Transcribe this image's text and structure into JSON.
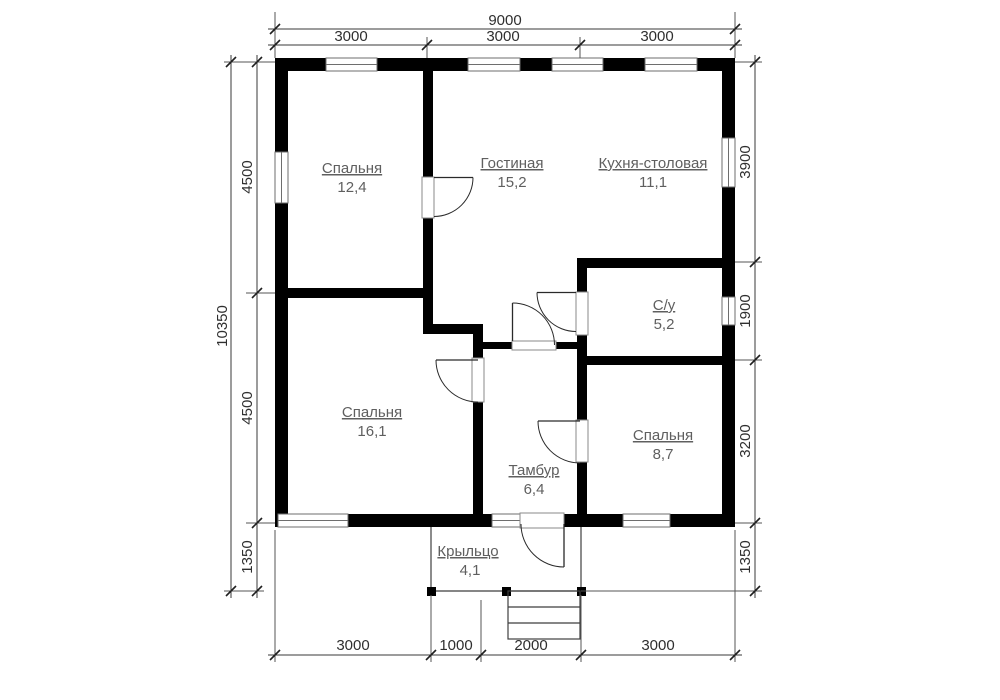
{
  "plan": {
    "rooms": [
      {
        "name": "Спальня",
        "area": "12,4"
      },
      {
        "name": "Гостиная",
        "area": "15,2"
      },
      {
        "name": "Кухня-столовая",
        "area": "11,1"
      },
      {
        "name": "С/у",
        "area": "5,2"
      },
      {
        "name": "Спальня",
        "area": "16,1"
      },
      {
        "name": "Спальня",
        "area": "8,7"
      },
      {
        "name": "Тамбур",
        "area": "6,4"
      },
      {
        "name": "Крыльцо",
        "area": "4,1"
      }
    ],
    "dimensions": {
      "top_total": "9000",
      "top_segments": [
        "3000",
        "3000",
        "3000"
      ],
      "left_total": "10350",
      "left_segments": [
        "4500",
        "4500",
        "1350"
      ],
      "right_segments": [
        "3900",
        "1900",
        "3200",
        "1350"
      ],
      "bottom_segments": [
        "3000",
        "1000",
        "2000",
        "3000"
      ]
    },
    "colors": {
      "wall": "#000000",
      "label": "#5f5f5f",
      "dimension": "#2f2f2f"
    }
  }
}
